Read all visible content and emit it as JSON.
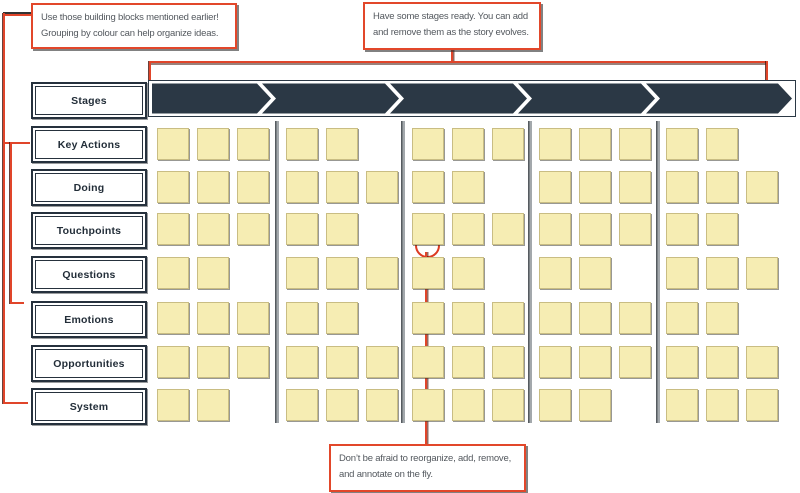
{
  "callouts": {
    "top_left": {
      "line1": "Use those building blocks mentioned earlier!",
      "line2": "Grouping by colour can help organize ideas."
    },
    "top_right": {
      "line1": "Have some stages ready. You can add",
      "line2": "and remove them as the story evolves."
    },
    "bottom": {
      "line1": "Don’t be afraid to reorganize, add, remove,",
      "line2": "and annotate on the fly."
    }
  },
  "row_labels": [
    "Stages",
    "Key Actions",
    "Doing",
    "Touchpoints",
    "Questions",
    "Emotions",
    "Opportunities",
    "System"
  ],
  "stages": {
    "count": 5
  },
  "notes": {
    "rows": [
      {
        "label": "Key Actions",
        "counts": [
          3,
          2,
          3,
          3,
          2
        ]
      },
      {
        "label": "Doing",
        "counts": [
          3,
          3,
          2,
          3,
          3
        ]
      },
      {
        "label": "Touchpoints",
        "counts": [
          3,
          2,
          3,
          3,
          2
        ]
      },
      {
        "label": "Questions",
        "counts": [
          2,
          3,
          2,
          2,
          3
        ]
      },
      {
        "label": "Emotions",
        "counts": [
          3,
          2,
          3,
          3,
          2
        ]
      },
      {
        "label": "Opportunities",
        "counts": [
          3,
          3,
          3,
          3,
          3
        ]
      },
      {
        "label": "System",
        "counts": [
          2,
          3,
          3,
          2,
          3
        ]
      }
    ]
  },
  "colors": {
    "sticky_note": "#F6EDB3",
    "stage_fill": "#2B3845",
    "accent_red": "#E0452A",
    "divider_gray": "#A3A8AC",
    "callout_text": "#53585E",
    "label_text": "#232E39"
  }
}
